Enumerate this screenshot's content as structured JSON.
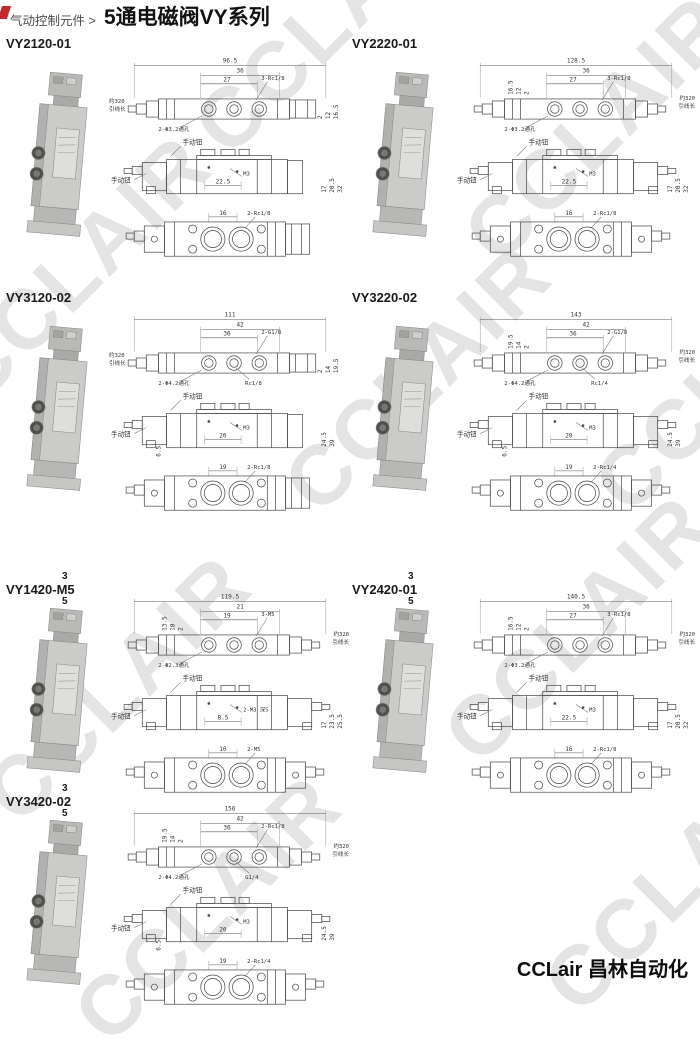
{
  "page": {
    "breadcrumb": "气动控制元件 >",
    "title": "5通电磁阀VY系列",
    "footer": "CCLair 昌林自动化",
    "watermark": "CCLAIR",
    "accent_red": "#c4272c"
  },
  "sections": [
    {
      "title": "VY2120-01",
      "sup": "",
      "sub": "",
      "dual": false,
      "top": {
        "total": "96.5",
        "a": "36",
        "b": "27",
        "thread": "3-Rc1/8",
        "holes": "2-Φ3.2通孔",
        "port": "",
        "v": [
          "16.5",
          "12",
          "2"
        ],
        "lead": [
          "约320",
          "引线长"
        ]
      },
      "mid": {
        "knob_top": "手动钮",
        "knob_left": "手动钮",
        "c": "22.5",
        "thread2": "M3",
        "s": "",
        "v": [
          "17",
          "20.5",
          "32"
        ]
      },
      "bot": {
        "d": "16",
        "thread3": "2-Rc1/8"
      }
    },
    {
      "title": "VY2220-01",
      "sup": "",
      "sub": "",
      "dual": true,
      "top": {
        "total": "128.5",
        "a": "36",
        "b": "27",
        "thread": "3-Rc1/8",
        "holes": "2-Φ3.2通孔",
        "port": "",
        "v": [
          "16.5",
          "12",
          "2"
        ],
        "lead": [
          "约320",
          "引线长"
        ]
      },
      "mid": {
        "knob_top": "手动钮",
        "knob_left": "手动钮",
        "c": "22.5",
        "thread2": "M3",
        "s": "",
        "v": [
          "17",
          "20.5",
          "32"
        ]
      },
      "bot": {
        "d": "16",
        "thread3": "2-Rc1/8"
      }
    },
    {
      "title": "VY3120-02",
      "sup": "",
      "sub": "",
      "dual": false,
      "top": {
        "total": "111",
        "a": "42",
        "b": "36",
        "thread": "2-G1/8",
        "holes": "2-Φ4.2通孔",
        "port": "Rc1/8",
        "v": [
          "19.5",
          "14",
          "2"
        ],
        "lead": [
          "约320",
          "引线长"
        ]
      },
      "mid": {
        "knob_top": "手动钮",
        "knob_left": "手动钮",
        "c": "20",
        "thread2": "M3",
        "s": "6.5",
        "v": [
          "24.5",
          "39",
          ""
        ]
      },
      "bot": {
        "d": "19",
        "thread3": "2-Rc1/8"
      }
    },
    {
      "title": "VY3220-02",
      "sup": "",
      "sub": "",
      "dual": true,
      "top": {
        "total": "143",
        "a": "42",
        "b": "36",
        "thread": "2-G1/8",
        "holes": "2-Φ4.2通孔",
        "port": "Rc1/4",
        "v": [
          "19.5",
          "14",
          "2"
        ],
        "lead": [
          "约320",
          "引线长"
        ]
      },
      "mid": {
        "knob_top": "手动钮",
        "knob_left": "手动钮",
        "c": "20",
        "thread2": "M3",
        "s": "6.5",
        "v": [
          "24.5",
          "39",
          ""
        ]
      },
      "bot": {
        "d": "19",
        "thread3": "2-Rc1/4"
      }
    },
    {
      "title": "VY1420-M5",
      "sup": "3",
      "sub": "5",
      "dual": true,
      "top": {
        "total": "119.5",
        "a": "21",
        "b": "19",
        "thread": "3-M5",
        "holes": "2-Φ2.3通孔",
        "port": "",
        "v": [
          "13.5",
          "10",
          "2"
        ],
        "lead": [
          "约320",
          "引线长"
        ]
      },
      "mid": {
        "knob_top": "手动钮",
        "knob_left": "手动钮",
        "c": "8.5",
        "thread2": "2-M3 深5",
        "s": "",
        "v": [
          "17",
          "23.5",
          "25.5"
        ]
      },
      "bot": {
        "d": "10",
        "thread3": "2-M5"
      }
    },
    {
      "title": "VY2420-01",
      "sup": "3",
      "sub": "5",
      "dual": true,
      "top": {
        "total": "140.5",
        "a": "36",
        "b": "27",
        "thread": "3-Rc1/8",
        "holes": "2-Φ3.2通孔",
        "port": "",
        "v": [
          "16.5",
          "12",
          "2"
        ],
        "lead": [
          "约320",
          "引线长"
        ]
      },
      "mid": {
        "knob_top": "手动钮",
        "knob_left": "手动钮",
        "c": "22.5",
        "thread2": "M3",
        "s": "",
        "v": [
          "17",
          "20.5",
          "32"
        ]
      },
      "bot": {
        "d": "16",
        "thread3": "2-Rc1/8"
      }
    },
    {
      "title": "VY3420-02",
      "sup": "3",
      "sub": "5",
      "dual": true,
      "top": {
        "total": "156",
        "a": "42",
        "b": "36",
        "thread": "2-Rc1/8",
        "holes": "2-Φ4.2通孔",
        "port": "G1/4",
        "v": [
          "19.5",
          "14",
          "2"
        ],
        "lead": [
          "约320",
          "引线长"
        ]
      },
      "mid": {
        "knob_top": "手动钮",
        "knob_left": "手动钮",
        "c": "20",
        "thread2": "M3",
        "s": "6.5",
        "v": [
          "24.5",
          "39",
          ""
        ]
      },
      "bot": {
        "d": "19",
        "thread3": "2-Rc1/4"
      }
    }
  ]
}
